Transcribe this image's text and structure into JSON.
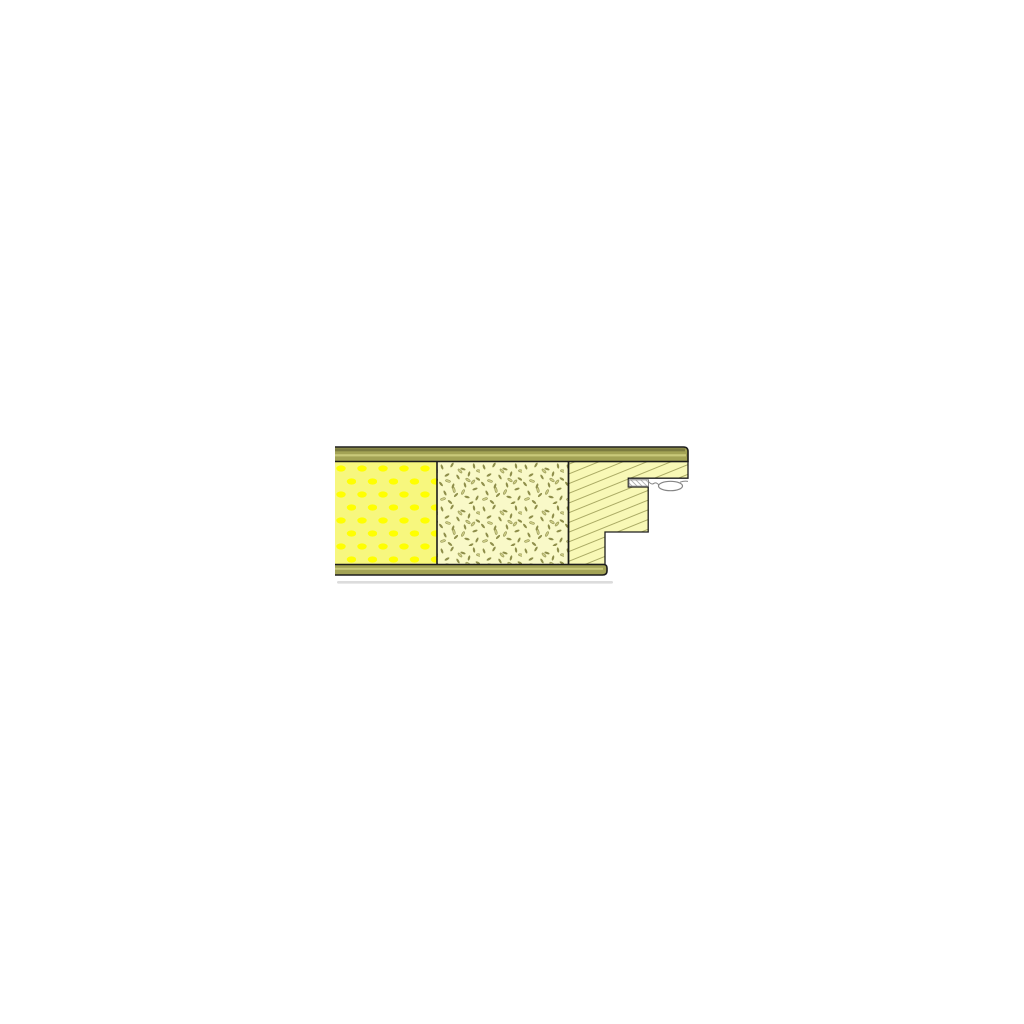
{
  "canvas": {
    "background": "#ffffff"
  },
  "drawing": {
    "kind": "section-detail",
    "layers": {
      "top_skin": "top-skin-band",
      "bottom_skin": "bottom-skin-band",
      "insulation": "dotted-insulation-layer",
      "core_board": "flecked-core-board-layer",
      "timber": "hatched-timber-edge",
      "gasket": "kerf-gasket-seal",
      "shadow": "drop-shadow-line"
    },
    "colors": {
      "background": "#ffffff",
      "outline": "#1c1c1c",
      "band_face": "#a3a355",
      "band_dark": "#7b7b3f",
      "band_light": "#c9c97a",
      "insulation_bg": "#f7f77e",
      "insulation_dot": "#ffff00",
      "board_bg": "#f9f9c8",
      "fleck_dark": "#8e8e4a",
      "fleck_light": "#cdcd86",
      "fleck_edge": "#83833f",
      "timber_bg": "#f8f8b6",
      "hatch_line": "#a2a25c",
      "gasket_stroke": "#858585",
      "gasket_fill": "#ffffff",
      "gasket_hatch": "#9a9a9a",
      "shadow": "#dcdcdc"
    }
  }
}
